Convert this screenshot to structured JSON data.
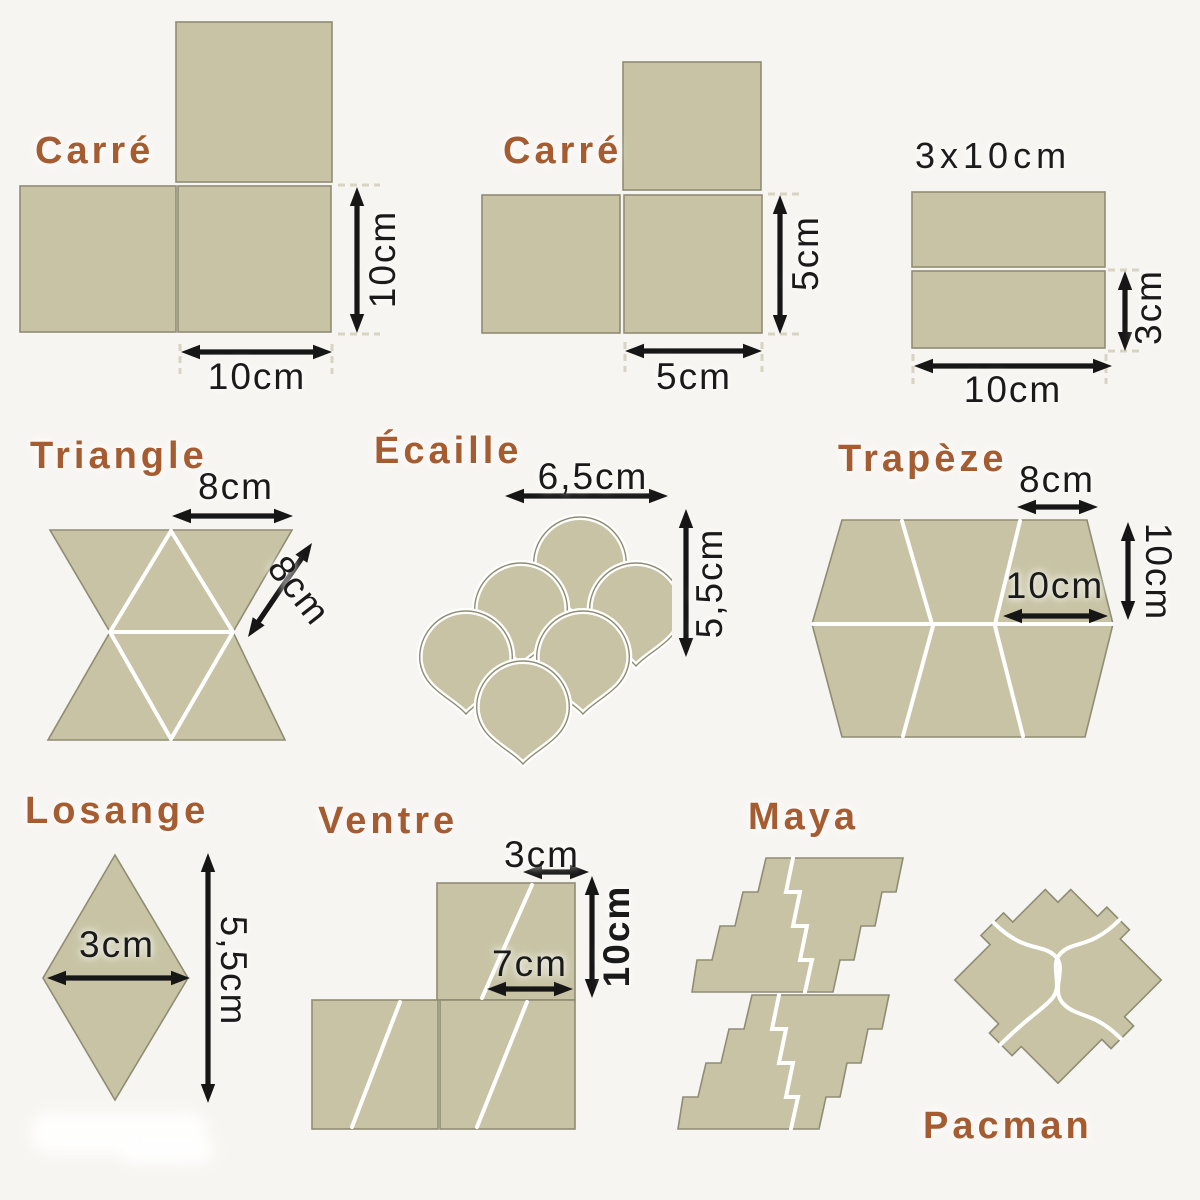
{
  "colors": {
    "background": "#f7f5f1",
    "tile_fill": "#c7c3a4",
    "tile_border": "#8f8c74",
    "seam": "#ffffff",
    "label_accent": "#a55c31",
    "dimension_text": "#1a1a1a",
    "arrow": "#161616"
  },
  "sections": {
    "carre10": {
      "title": "Carré",
      "width_dim": "10cm",
      "height_dim": "10cm"
    },
    "carre5": {
      "title": "Carré",
      "width_dim": "5cm",
      "height_dim": "5cm"
    },
    "rect3x10": {
      "title": "3x10cm",
      "width_dim": "10cm",
      "height_dim": "3cm"
    },
    "triangle": {
      "title": "Triangle",
      "top_dim": "8cm",
      "side_dim": "8cm"
    },
    "ecaille": {
      "title": "Écaille",
      "width_dim": "6,5cm",
      "height_dim": "5,5cm"
    },
    "trapeze": {
      "title": "Trapèze",
      "top_dim": "8cm",
      "inner_dim": "10cm",
      "height_dim": "10cm"
    },
    "losange": {
      "title": "Losange",
      "width_dim": "3cm",
      "height_dim": "5,5cm"
    },
    "ventre": {
      "title": "Ventre",
      "top_dim": "3cm",
      "height_dim": "10cm",
      "inner_dim": "7cm"
    },
    "maya": {
      "title": "Maya"
    },
    "pacman": {
      "title": "Pacman"
    }
  }
}
